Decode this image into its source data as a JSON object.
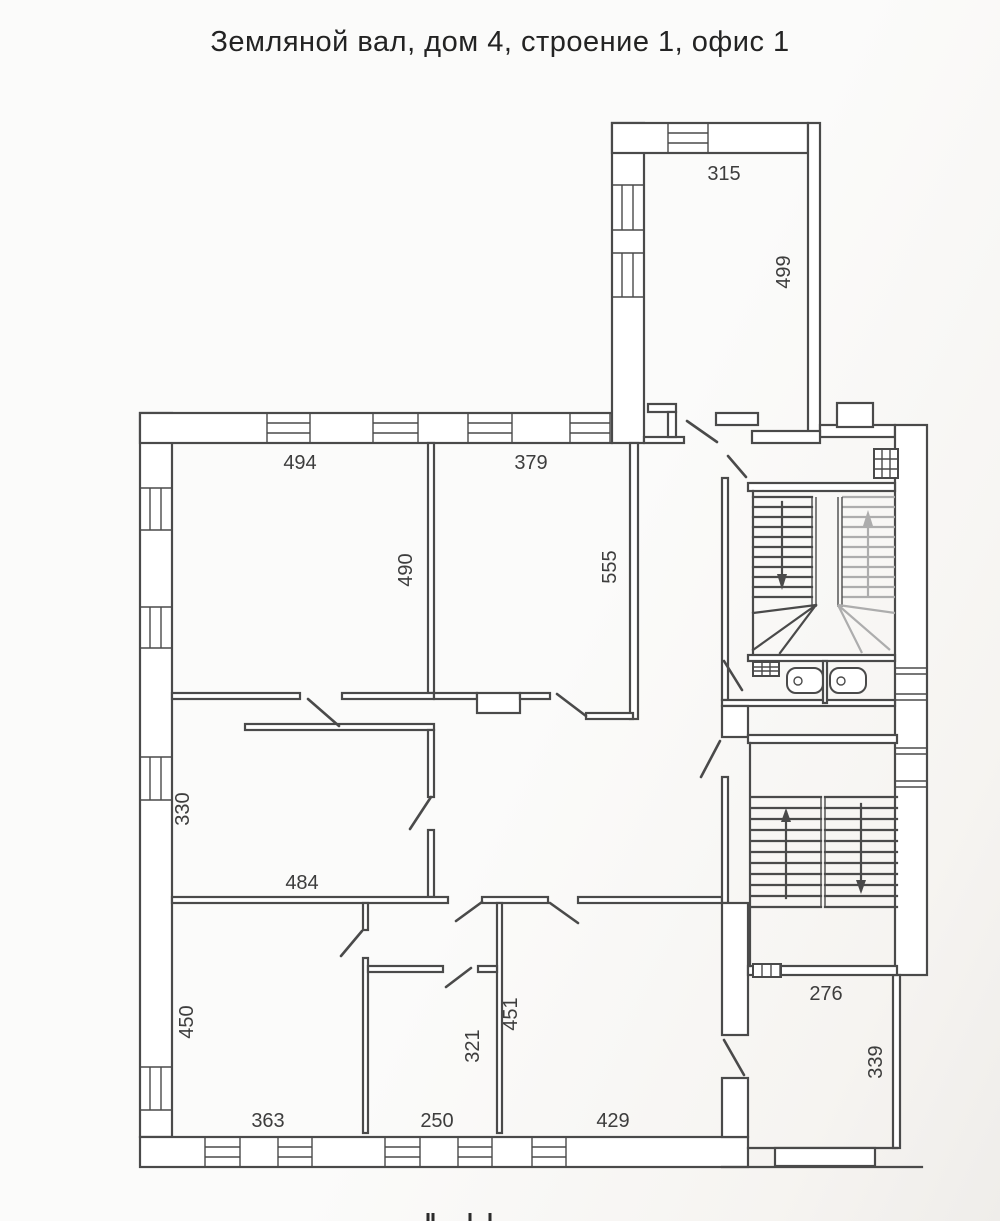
{
  "title": "Земляной вал, дом 4, строение 1, офис 1",
  "floor_plan": {
    "type": "apartment-office floor plan, scanned line drawing",
    "colors": {
      "line": "#4a4a4a",
      "secondary_stair_flight": "#adadad",
      "background": "#fbfbfa",
      "text": "#3d3d3d"
    },
    "labels": {
      "d315": "315",
      "d499": "499",
      "d494": "494",
      "d379": "379",
      "d490": "490",
      "d555": "555",
      "d330": "330",
      "d484": "484",
      "d450": "450",
      "d363": "363",
      "d250": "250",
      "d321": "321",
      "d451": "451",
      "d429": "429",
      "d276": "276",
      "d339": "339"
    },
    "rooms": [
      {
        "id": "room-top-annex",
        "width_label_key": "d315",
        "depth_label_key": "d499"
      },
      {
        "id": "room-north-west",
        "width_label_key": "d494",
        "depth_label_key": "d490"
      },
      {
        "id": "room-north",
        "width_label_key": "d379",
        "depth_label_key": "d555"
      },
      {
        "id": "room-west",
        "depth_label_key": "d330",
        "corridor_label_key": "d484"
      },
      {
        "id": "room-south-west",
        "width_label_key": "d363",
        "depth_label_key": "d450"
      },
      {
        "id": "room-south",
        "width_label_key": "d250",
        "depth_label_key": "d321"
      },
      {
        "id": "room-south-east",
        "width_label_key": "d429",
        "depth_label_key": "d451"
      },
      {
        "id": "room-east",
        "width_label_key": "d276",
        "depth_label_key": "d339"
      }
    ]
  }
}
